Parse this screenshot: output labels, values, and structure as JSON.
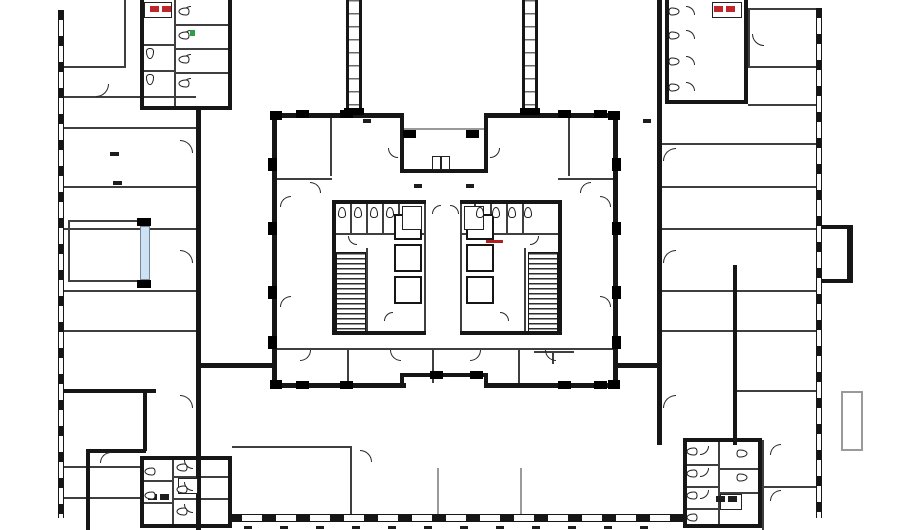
{
  "meta": {
    "title": "Office building floor plan — courtyard tower level",
    "width": 900,
    "height": 530
  },
  "palette": {
    "bg": "#ffffff",
    "wall": "#161616",
    "thin": "#3f3f3f",
    "light": "#9a9a9a",
    "glazing": "#cfe2f2",
    "accent_red": "#c0272d",
    "accent_green": "#2f9e44"
  },
  "plan": {
    "wall": [
      [
        272,
        113,
        132,
        5
      ],
      [
        484,
        113,
        134,
        5
      ],
      [
        400,
        113,
        4,
        60
      ],
      [
        484,
        113,
        4,
        60
      ],
      [
        400,
        169,
        88,
        4
      ],
      [
        272,
        383,
        134,
        5
      ],
      [
        484,
        383,
        134,
        5
      ],
      [
        400,
        373,
        88,
        4
      ],
      [
        400,
        373,
        4,
        12
      ],
      [
        484,
        373,
        4,
        12
      ],
      [
        272,
        113,
        5,
        275
      ],
      [
        613,
        113,
        5,
        275
      ],
      [
        332,
        200,
        94,
        4
      ],
      [
        460,
        200,
        102,
        4
      ],
      [
        332,
        331,
        94,
        4
      ],
      [
        460,
        331,
        102,
        4
      ],
      [
        332,
        200,
        4,
        135
      ],
      [
        558,
        200,
        4,
        135
      ],
      [
        196,
        363,
        78,
        5
      ],
      [
        618,
        363,
        44,
        5
      ],
      [
        140,
        0,
        4,
        110
      ],
      [
        228,
        0,
        4,
        110
      ],
      [
        140,
        106,
        92,
        4
      ],
      [
        196,
        110,
        5,
        420
      ],
      [
        64,
        389,
        92,
        4
      ],
      [
        143,
        389,
        4,
        62
      ],
      [
        88,
        449,
        58,
        4
      ],
      [
        86,
        449,
        4,
        81
      ],
      [
        140,
        456,
        92,
        4
      ],
      [
        140,
        456,
        4,
        72
      ],
      [
        228,
        456,
        4,
        72
      ],
      [
        140,
        524,
        92,
        4
      ],
      [
        665,
        0,
        4,
        104
      ],
      [
        744,
        0,
        4,
        104
      ],
      [
        665,
        100,
        83,
        4
      ],
      [
        657,
        0,
        5,
        445
      ],
      [
        733,
        265,
        4,
        180
      ],
      [
        683,
        438,
        79,
        4
      ],
      [
        683,
        438,
        4,
        90
      ],
      [
        758,
        438,
        4,
        90
      ],
      [
        683,
        524,
        79,
        4
      ],
      [
        847,
        225,
        6,
        58
      ],
      [
        822,
        225,
        27,
        4
      ],
      [
        822,
        279,
        27,
        4
      ]
    ],
    "thin": [
      [
        64,
        66,
        62,
        2
      ],
      [
        64,
        96,
        132,
        2
      ],
      [
        64,
        127,
        132,
        2
      ],
      [
        64,
        186,
        132,
        2
      ],
      [
        64,
        228,
        132,
        2
      ],
      [
        64,
        290,
        132,
        2
      ],
      [
        64,
        330,
        132,
        2
      ],
      [
        124,
        0,
        2,
        66
      ],
      [
        64,
        466,
        78,
        2
      ],
      [
        64,
        497,
        78,
        2
      ],
      [
        68,
        220,
        72,
        2
      ],
      [
        68,
        280,
        72,
        2
      ],
      [
        68,
        220,
        2,
        62
      ],
      [
        174,
        0,
        2,
        106
      ],
      [
        176,
        24,
        52,
        2
      ],
      [
        176,
        48,
        52,
        2
      ],
      [
        176,
        72,
        52,
        2
      ],
      [
        140,
        44,
        34,
        2
      ],
      [
        140,
        70,
        34,
        2
      ],
      [
        277,
        348,
        336,
        2
      ],
      [
        347,
        350,
        2,
        33
      ],
      [
        432,
        350,
        2,
        33
      ],
      [
        518,
        350,
        2,
        33
      ],
      [
        277,
        178,
        55,
        2
      ],
      [
        558,
        178,
        55,
        2
      ],
      [
        330,
        118,
        2,
        58
      ],
      [
        568,
        118,
        2,
        58
      ],
      [
        424,
        204,
        2,
        127
      ],
      [
        460,
        204,
        2,
        127
      ],
      [
        334,
        233,
        90,
        2
      ],
      [
        366,
        248,
        2,
        85
      ],
      [
        334,
        265,
        32,
        2
      ],
      [
        462,
        233,
        96,
        2
      ],
      [
        524,
        248,
        2,
        85
      ],
      [
        350,
        204,
        2,
        29
      ],
      [
        366,
        204,
        2,
        29
      ],
      [
        382,
        204,
        2,
        29
      ],
      [
        398,
        204,
        2,
        29
      ],
      [
        474,
        204,
        2,
        29
      ],
      [
        490,
        204,
        2,
        29
      ],
      [
        506,
        204,
        2,
        29
      ],
      [
        522,
        204,
        2,
        29
      ],
      [
        534,
        351,
        40,
        2
      ],
      [
        552,
        352,
        2,
        12
      ],
      [
        748,
        8,
        68,
        2
      ],
      [
        748,
        8,
        2,
        58
      ],
      [
        748,
        66,
        68,
        2
      ],
      [
        748,
        104,
        68,
        2
      ],
      [
        662,
        143,
        154,
        2
      ],
      [
        662,
        186,
        154,
        2
      ],
      [
        662,
        228,
        154,
        2
      ],
      [
        662,
        290,
        154,
        2
      ],
      [
        662,
        330,
        154,
        2
      ],
      [
        737,
        390,
        79,
        2
      ],
      [
        762,
        440,
        2,
        90
      ],
      [
        762,
        486,
        54,
        2
      ],
      [
        232,
        446,
        118,
        2
      ],
      [
        350,
        446,
        2,
        70
      ],
      [
        172,
        458,
        2,
        66
      ],
      [
        140,
        480,
        32,
        2
      ],
      [
        140,
        502,
        32,
        2
      ],
      [
        172,
        476,
        56,
        2
      ],
      [
        172,
        498,
        56,
        2
      ],
      [
        718,
        442,
        2,
        82
      ],
      [
        683,
        464,
        35,
        2
      ],
      [
        683,
        486,
        35,
        2
      ],
      [
        683,
        508,
        35,
        2
      ],
      [
        720,
        468,
        38,
        2
      ],
      [
        720,
        492,
        38,
        2
      ]
    ],
    "light": [
      [
        404,
        128,
        80,
        2
      ],
      [
        437,
        468,
        2,
        48
      ],
      [
        520,
        468,
        2,
        48
      ],
      [
        841,
        391,
        22,
        2
      ],
      [
        841,
        449,
        22,
        2
      ],
      [
        841,
        391,
        2,
        60
      ],
      [
        861,
        391,
        2,
        60
      ]
    ],
    "column": [
      [
        296,
        110,
        13,
        8
      ],
      [
        340,
        110,
        13,
        8
      ],
      [
        558,
        110,
        13,
        8
      ],
      [
        594,
        110,
        13,
        8
      ],
      [
        403,
        130,
        13,
        8
      ],
      [
        466,
        130,
        13,
        8
      ],
      [
        268,
        158,
        9,
        13
      ],
      [
        268,
        222,
        9,
        13
      ],
      [
        268,
        286,
        9,
        13
      ],
      [
        268,
        336,
        9,
        13
      ],
      [
        612,
        158,
        9,
        13
      ],
      [
        612,
        222,
        9,
        13
      ],
      [
        612,
        286,
        9,
        13
      ],
      [
        612,
        336,
        9,
        13
      ],
      [
        296,
        381,
        13,
        8
      ],
      [
        340,
        381,
        13,
        8
      ],
      [
        430,
        371,
        13,
        8
      ],
      [
        470,
        371,
        13,
        8
      ],
      [
        558,
        381,
        13,
        8
      ],
      [
        594,
        381,
        13,
        8
      ],
      [
        270,
        111,
        12,
        9
      ],
      [
        608,
        111,
        12,
        9
      ],
      [
        270,
        380,
        12,
        9
      ],
      [
        608,
        380,
        12,
        9
      ],
      [
        344,
        108,
        20,
        7
      ],
      [
        520,
        108,
        20,
        7
      ],
      [
        137,
        218,
        14,
        8
      ],
      [
        137,
        280,
        14,
        8
      ]
    ],
    "winv": [
      [
        58,
        10,
        6,
        508
      ],
      [
        816,
        8,
        6,
        510
      ]
    ],
    "winh": [
      [
        228,
        514,
        456,
        8
      ]
    ],
    "conn": [
      [
        346,
        0,
        16,
        112
      ],
      [
        522,
        0,
        16,
        112
      ]
    ],
    "stair": [
      [
        336,
        252,
        30,
        80
      ],
      [
        528,
        252,
        30,
        80
      ]
    ],
    "lift": [
      [
        394,
        214,
        28,
        26
      ],
      [
        394,
        244,
        28,
        28
      ],
      [
        394,
        276,
        28,
        28
      ],
      [
        466,
        214,
        28,
        26
      ],
      [
        466,
        244,
        28,
        28
      ],
      [
        466,
        276,
        28,
        28
      ]
    ],
    "glazing": [
      [
        140,
        226,
        10,
        54
      ]
    ],
    "sink": [
      [
        144,
        2,
        28,
        16
      ],
      [
        712,
        2,
        30,
        16
      ],
      [
        402,
        206,
        20,
        24
      ],
      [
        464,
        206,
        20,
        24
      ],
      [
        178,
        478,
        20,
        16
      ],
      [
        720,
        494,
        22,
        16
      ],
      [
        432,
        156,
        9,
        14
      ],
      [
        441,
        156,
        9,
        14
      ]
    ],
    "toilet": [
      [
        180,
        6,
        90
      ],
      [
        180,
        30,
        90
      ],
      [
        180,
        54,
        90
      ],
      [
        180,
        78,
        90
      ],
      [
        146,
        48,
        0
      ],
      [
        146,
        74,
        0
      ],
      [
        670,
        6,
        -90
      ],
      [
        670,
        30,
        -90
      ],
      [
        670,
        56,
        -90
      ],
      [
        670,
        82,
        -90
      ],
      [
        338,
        207,
        180
      ],
      [
        354,
        207,
        180
      ],
      [
        370,
        207,
        180
      ],
      [
        386,
        207,
        180
      ],
      [
        476,
        207,
        180
      ],
      [
        492,
        207,
        180
      ],
      [
        508,
        207,
        180
      ],
      [
        524,
        207,
        180
      ],
      [
        178,
        462,
        90
      ],
      [
        178,
        484,
        90
      ],
      [
        178,
        506,
        90
      ],
      [
        146,
        466,
        90
      ],
      [
        146,
        490,
        90
      ],
      [
        688,
        446,
        90
      ],
      [
        688,
        468,
        90
      ],
      [
        688,
        490,
        90
      ],
      [
        688,
        512,
        90
      ],
      [
        738,
        448,
        -90
      ],
      [
        738,
        472,
        -90
      ]
    ],
    "door": [
      [
        180,
        140,
        13,
        "tr"
      ],
      [
        180,
        250,
        13,
        "tr"
      ],
      [
        180,
        395,
        13,
        "tr"
      ],
      [
        663,
        148,
        13,
        "tl"
      ],
      [
        663,
        250,
        13,
        "tl"
      ],
      [
        663,
        395,
        13,
        "tl"
      ],
      [
        300,
        350,
        11,
        "br"
      ],
      [
        390,
        350,
        11,
        "bl"
      ],
      [
        470,
        350,
        11,
        "br"
      ],
      [
        545,
        350,
        11,
        "bl"
      ],
      [
        310,
        182,
        11,
        "tr"
      ],
      [
        580,
        182,
        11,
        "tl"
      ],
      [
        280,
        196,
        11,
        "tl"
      ],
      [
        280,
        296,
        11,
        "tl"
      ],
      [
        600,
        196,
        11,
        "tr"
      ],
      [
        600,
        296,
        11,
        "tr"
      ],
      [
        388,
        148,
        10,
        "bl"
      ],
      [
        490,
        148,
        10,
        "br"
      ],
      [
        348,
        236,
        9,
        "bl"
      ],
      [
        384,
        312,
        9,
        "tl"
      ],
      [
        500,
        312,
        9,
        "tr"
      ],
      [
        432,
        205,
        9,
        "tl"
      ],
      [
        450,
        205,
        9,
        "tr"
      ],
      [
        530,
        236,
        9,
        "br"
      ],
      [
        182,
        6,
        9,
        "tl"
      ],
      [
        182,
        30,
        9,
        "tl"
      ],
      [
        182,
        54,
        9,
        "tl"
      ],
      [
        182,
        78,
        9,
        "tl"
      ],
      [
        686,
        6,
        9,
        "tr"
      ],
      [
        686,
        30,
        9,
        "tr"
      ],
      [
        686,
        56,
        9,
        "tr"
      ],
      [
        686,
        82,
        9,
        "tr"
      ],
      [
        184,
        460,
        9,
        "bl"
      ],
      [
        184,
        482,
        9,
        "bl"
      ],
      [
        184,
        504,
        9,
        "bl"
      ],
      [
        700,
        446,
        9,
        "br"
      ],
      [
        700,
        468,
        9,
        "br"
      ],
      [
        700,
        490,
        9,
        "br"
      ],
      [
        96,
        84,
        13,
        "br"
      ],
      [
        752,
        34,
        12,
        "bl"
      ],
      [
        360,
        450,
        12,
        "tr"
      ],
      [
        770,
        444,
        11,
        "tl"
      ],
      [
        770,
        490,
        11,
        "tl"
      ],
      [
        100,
        452,
        11,
        "tl"
      ]
    ],
    "mark": [
      [
        110,
        152,
        9,
        4
      ],
      [
        113,
        181,
        9,
        4
      ],
      [
        363,
        119,
        8,
        4
      ],
      [
        643,
        119,
        8,
        4
      ],
      [
        414,
        184,
        8,
        4
      ],
      [
        466,
        184,
        8,
        4
      ],
      [
        148,
        494,
        9,
        6
      ],
      [
        160,
        494,
        9,
        6
      ],
      [
        716,
        496,
        9,
        6
      ],
      [
        728,
        496,
        9,
        6
      ],
      [
        244,
        526,
        8,
        3
      ],
      [
        280,
        526,
        8,
        3
      ],
      [
        316,
        526,
        8,
        3
      ],
      [
        352,
        526,
        8,
        3
      ],
      [
        388,
        526,
        8,
        3
      ],
      [
        424,
        526,
        8,
        3
      ],
      [
        460,
        526,
        8,
        3
      ],
      [
        496,
        526,
        8,
        3
      ],
      [
        532,
        526,
        8,
        3
      ],
      [
        568,
        526,
        8,
        3
      ],
      [
        604,
        526,
        8,
        3
      ],
      [
        640,
        526,
        8,
        3
      ]
    ],
    "accent": [
      [
        150,
        6,
        9,
        6,
        "#c0272d"
      ],
      [
        162,
        6,
        9,
        6,
        "#c0272d"
      ],
      [
        714,
        6,
        9,
        6,
        "#c0272d"
      ],
      [
        726,
        6,
        9,
        6,
        "#c0272d"
      ],
      [
        486,
        240,
        17,
        3,
        "#b02020"
      ],
      [
        190,
        30,
        5,
        6,
        "#2f9e44"
      ]
    ]
  }
}
